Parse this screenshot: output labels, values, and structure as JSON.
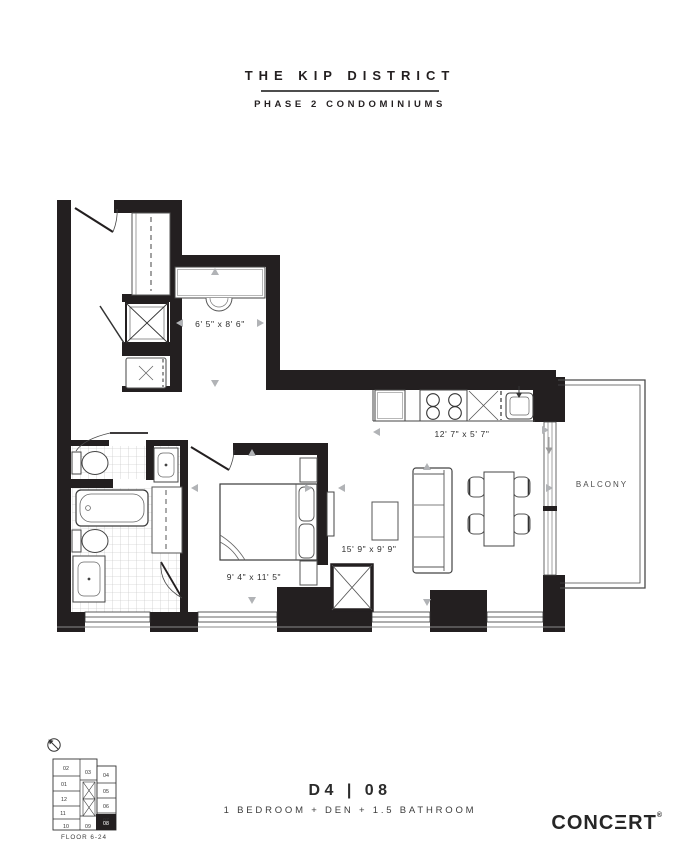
{
  "page": {
    "width": 700,
    "height": 842,
    "background": "#ffffff"
  },
  "header": {
    "title": "THE KIP DISTRICT",
    "subtitle": "PHASE 2 CONDOMINIUMS"
  },
  "plan": {
    "den_dim": "6' 5\" x 8' 6\"",
    "kitchen_dim": "12' 7\" x 5' 7\"",
    "living_dim": "15' 9\" x 9' 9\"",
    "bedroom_dim": "9' 4\" x 11' 5\"",
    "balcony_label": "BALCONY"
  },
  "keyplan": {
    "floors_label": "FLOOR 6-24",
    "units": [
      "02",
      "03",
      "04",
      "01",
      "05",
      "12",
      "06",
      "11",
      "07",
      "10",
      "09",
      "08"
    ],
    "highlighted_unit": "08"
  },
  "footer": {
    "unit_code": "D4 | 08",
    "description": "1 BEDROOM + DEN + 1.5 BATHROOM",
    "brand_pre": "CONC",
    "brand_e": "Ξ",
    "brand_post": "RT",
    "brand_reg": "®"
  },
  "colors": {
    "wall": "#231f20",
    "thin_line": "#4a4a4a",
    "dim_arrow": "#b1b3b6",
    "text": "#2b2b2b"
  }
}
